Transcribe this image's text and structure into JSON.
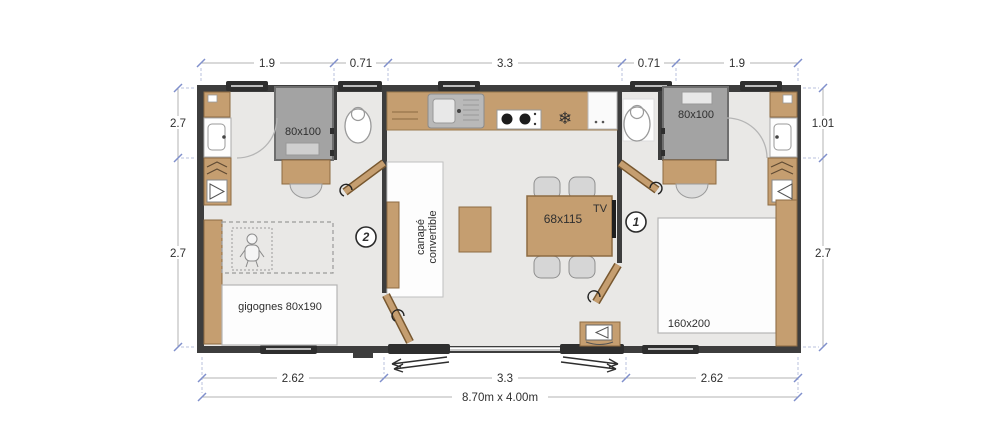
{
  "floor_plan": {
    "overall_dimensions": "8.70m x 4.00m",
    "dimensions": {
      "top": [
        "1.9",
        "0.71",
        "3.3",
        "0.71",
        "1.9"
      ],
      "bottom": [
        "2.62",
        "3.3",
        "2.62"
      ],
      "left": [
        "2.7",
        "2.7"
      ],
      "right": [
        "1.01",
        "2.7"
      ]
    },
    "rooms": {
      "bedroom_1": {
        "number": "1",
        "bed_label": "160x200"
      },
      "bedroom_2": {
        "number": "2",
        "bed_label": "gigognes 80x190"
      },
      "bathroom_left": {
        "shower_label": "80x100"
      },
      "bathroom_right": {
        "shower_label": "80x100"
      },
      "living": {
        "sofa_line1": "canapé",
        "sofa_line2": "convertible",
        "table_label": "68x115",
        "tv_label": "TV"
      }
    },
    "icons": {
      "fridge": "❄"
    },
    "colors": {
      "wall": "#3d3d3d",
      "wood": "#c59e70",
      "wood_border": "#8d6b42",
      "floor": "#e9e8e6",
      "shower": "#a3a3a3",
      "shower_border": "#6e6e6e",
      "dimension_tick": "#8090cc",
      "text": "#2f2f2f"
    }
  }
}
